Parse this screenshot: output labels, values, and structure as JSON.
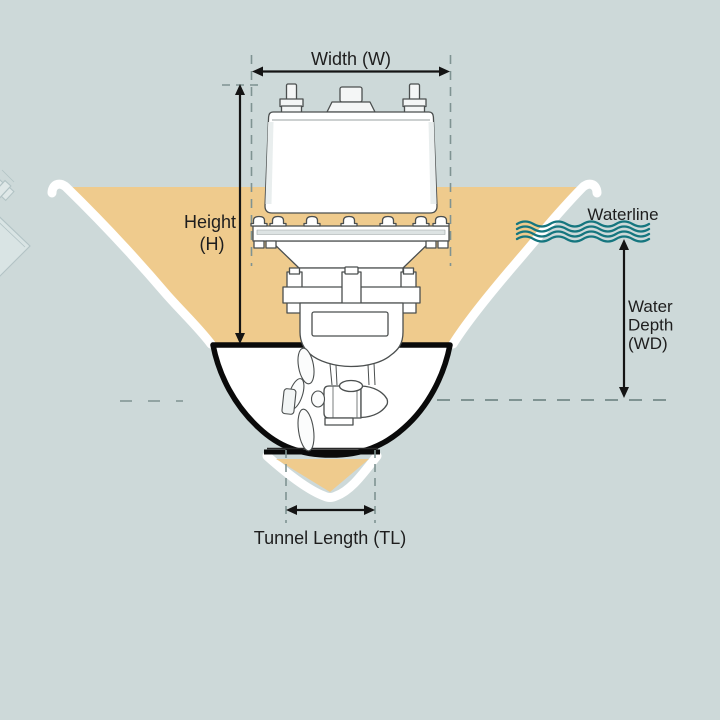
{
  "diagram": {
    "labels": {
      "width": "Width (W)",
      "height_line1": "Height",
      "height_line2": "(H)",
      "waterline": "Waterline",
      "water_depth_line1": "Water",
      "water_depth_line2": "Depth",
      "water_depth_line3": "(WD)",
      "tunnel_length": "Tunnel Length (TL)"
    },
    "icons": {
      "waterline_waves": "waterline-waves-icon"
    },
    "colors": {
      "background": "#cdd9d9",
      "hull_fill": "#efcb8d",
      "hull_plating": "#ffffff",
      "tunnel_outline": "#0a0a0a",
      "wave_teal": "#15767f",
      "dimension_dash": "#7f9392",
      "arrow": "#141414",
      "text": "#1e1e1e",
      "machine_outline": "#4b4f4f"
    }
  }
}
